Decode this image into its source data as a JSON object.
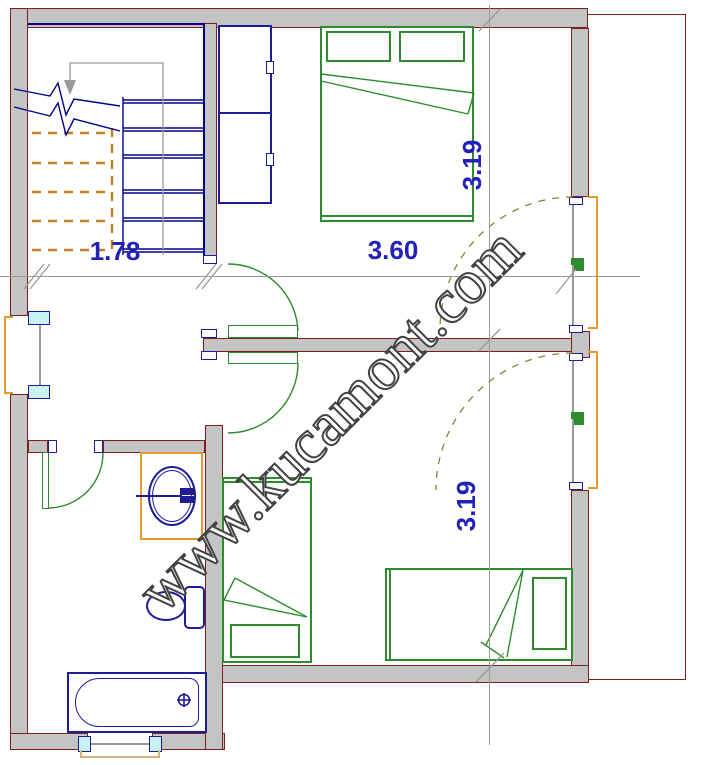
{
  "watermark": {
    "text": "www.kucamont.com"
  },
  "dimensions": {
    "hall_width": "1.78",
    "bedroom1_width": "3.60",
    "bedroom1_depth": "3.19",
    "bedroom2_depth": "3.19"
  },
  "colors": {
    "wall_fill": "#c4c4c4",
    "wall_edge": "#7d1f1f",
    "stair_edge": "#00008b",
    "furniture_green": "#2e8b2e",
    "fixture_blue": "#1c1c96",
    "frame_orange": "#e39b2d",
    "sill_tan": "#d9b272",
    "glass_cyan": "#c9f2f7",
    "stair_dash_orange": "#c87d1e",
    "swing_dash_olive": "#8f7f33",
    "dimension_blue": "#2222bb",
    "reference_gray": "#999999",
    "watermark_gray": "#424242"
  }
}
